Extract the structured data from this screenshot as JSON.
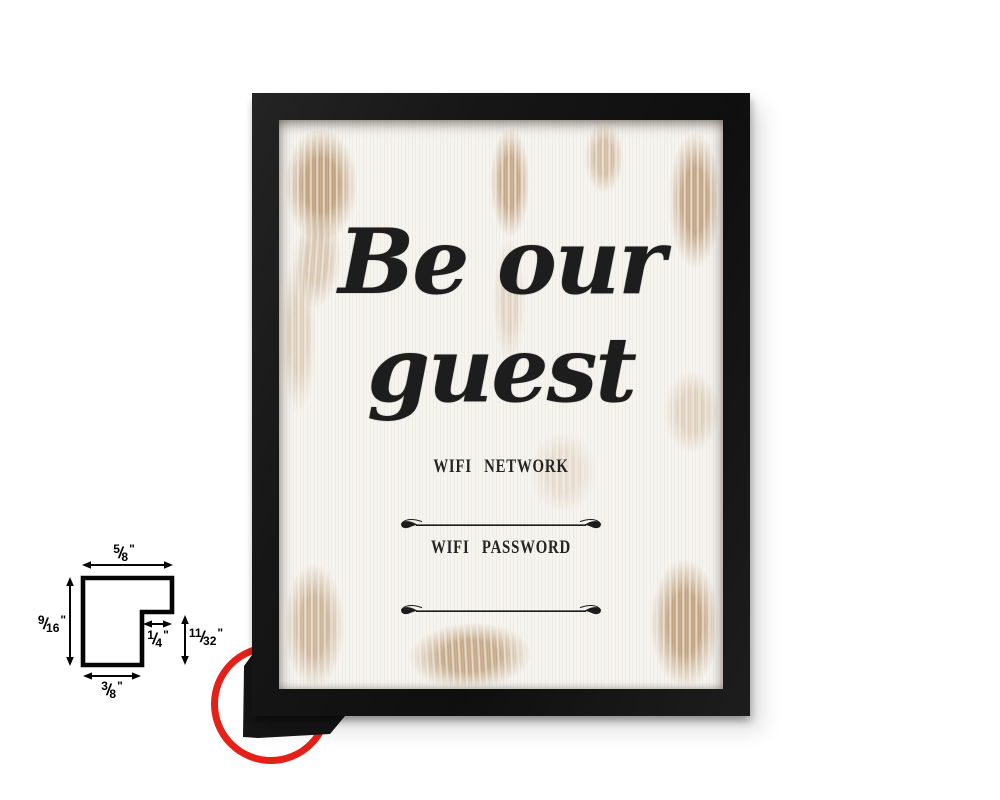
{
  "product_photo": {
    "framed_sign": {
      "quote_line1": "Be our",
      "quote_line2": "guest",
      "wifi_network_label": "WIFI NETWORK",
      "wifi_password_label": "WIFI PASSWORD",
      "frame_color": "#1a1a1a",
      "print_background_color": "#f6f4ef",
      "distress_color": "#b08a63"
    },
    "corner_highlight": {
      "shape": "circle",
      "color": "#e32119"
    },
    "profile_diagram": {
      "fraction_slash": "/",
      "unit_mark": "\"",
      "dimensions": {
        "top_width": {
          "numerator": "5",
          "denominator": "8"
        },
        "left_height": {
          "numerator": "9",
          "denominator": "16"
        },
        "rabbet_width": {
          "numerator": "1",
          "denominator": "4"
        },
        "right_height": {
          "numerator": "11",
          "denominator": "32"
        },
        "bottom_width": {
          "numerator": "3",
          "denominator": "8"
        }
      }
    }
  }
}
